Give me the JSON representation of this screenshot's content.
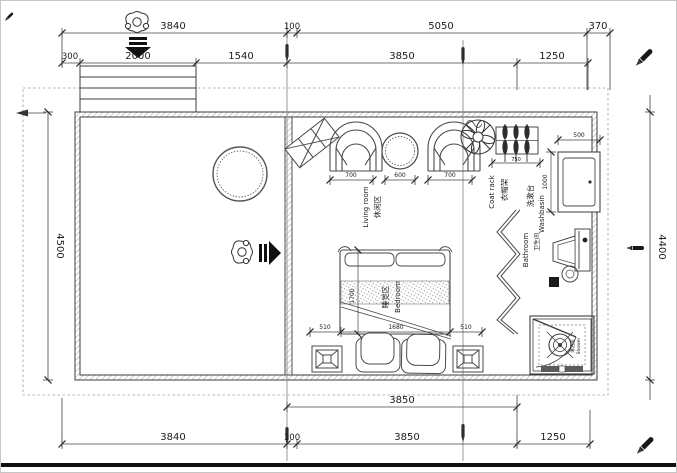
{
  "drawing": {
    "type": "floor-plan",
    "dims": {
      "top1": [
        "3840",
        "100",
        "5050",
        "370"
      ],
      "top2": [
        "300",
        "2000",
        "1540",
        "3850",
        "1250"
      ],
      "bottom1": [
        "3850"
      ],
      "bottom2": [
        "3840",
        "100",
        "3850",
        "1250"
      ],
      "left_height": "4500",
      "right_height": "4400",
      "living": [
        "700",
        "600",
        "700"
      ],
      "bed_bottom": [
        "510",
        "1680",
        "510"
      ],
      "bed_side": "1700",
      "coat_rack": "750",
      "washbasin_w": "500",
      "washbasin_h": "1000"
    },
    "rooms": {
      "living": {
        "cn": "休闲区",
        "en": "Living room"
      },
      "bedroom": {
        "cn": "睡觉区",
        "en": "Bedroom"
      },
      "coatrack": {
        "cn": "衣帽架",
        "en": "Coat rack"
      },
      "washbasin": {
        "cn": "洗漱台",
        "en": "Washbasin"
      },
      "bathroom": {
        "cn": "卫生间",
        "en": "Bathroom"
      },
      "shower": {
        "cn": "淋浴房",
        "en": "Shower"
      }
    },
    "colors": {
      "line": "#3c3c3c",
      "dim_line": "#444444",
      "hatch": "#8a8a8a",
      "page_border": "#c6c6c6",
      "footer_bar": "#101010"
    }
  }
}
